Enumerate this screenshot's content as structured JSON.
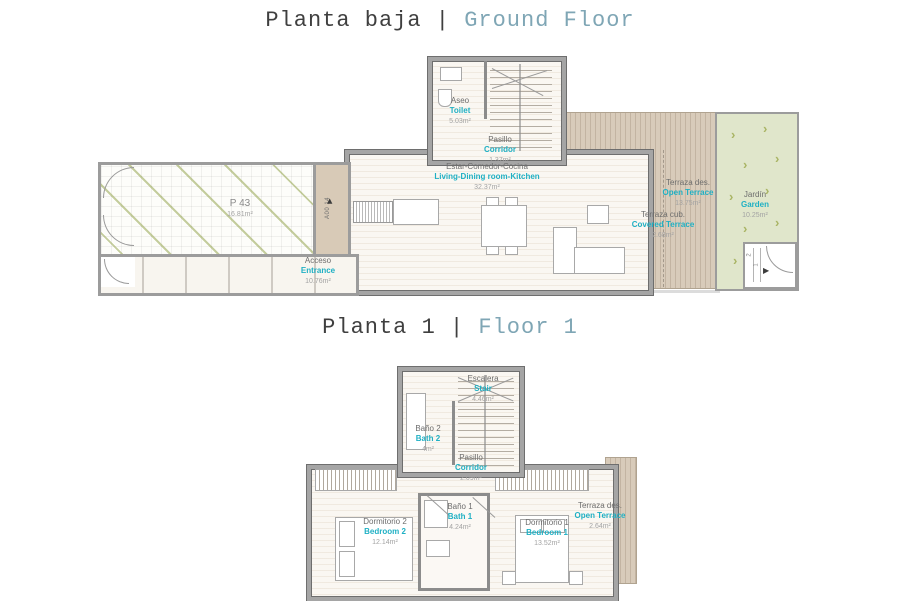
{
  "colors": {
    "accent_teal": "#1fb0c4",
    "title_teal": "#7fa6b5",
    "title_dark": "#3f3f3f",
    "label_gray": "#6d6d6d",
    "area_gray": "#a3a3a3",
    "garden_green": "#e0e6cb",
    "deck_tan": "#d8cbba"
  },
  "icons": {
    "door_arrow": "▶",
    "garden_chevron": "›"
  },
  "ground_floor": {
    "title": {
      "es": "Planta baja",
      "divider": "|",
      "en": "Ground Floor"
    },
    "door_tag": "A00 14",
    "garden_steps": {
      "step1": "1",
      "step2": "2"
    },
    "rooms": {
      "parking": {
        "es": "P 43",
        "area": "16.81m²"
      },
      "entrance": {
        "es": "Acceso",
        "en": "Entrance",
        "area": "10.76m²"
      },
      "toilet": {
        "es": "Aseo",
        "en": "Toilet",
        "area": "5.03m²"
      },
      "corridor": {
        "es": "Pasillo",
        "en": "Corridor",
        "area": "1.37m²"
      },
      "living": {
        "es": "Estar-Comedor-Cocina",
        "en": "Living-Dining room-Kitchen",
        "area": "32.37m²"
      },
      "open_terrace": {
        "es": "Terraza des.",
        "en": "Open Terrace",
        "area": "13.75m²"
      },
      "covered_terrace": {
        "es": "Terraza cub.",
        "en": "Covered Terrace",
        "area": "2.68m²"
      },
      "garden": {
        "es": "Jardín",
        "en": "Garden",
        "area": "10.25m²"
      }
    }
  },
  "floor_1": {
    "title": {
      "es": "Planta 1",
      "divider": "|",
      "en": "Floor 1"
    },
    "rooms": {
      "stair": {
        "es": "Escalera",
        "en": "Stair",
        "area": "4.46m²"
      },
      "bath_2": {
        "es": "Baño 2",
        "en": "Bath 2",
        "area": "4m²"
      },
      "corridor": {
        "es": "Pasillo",
        "en": "Corridor",
        "area": "2.09m²"
      },
      "bedroom_2": {
        "es": "Dormitorio 2",
        "en": "Bedroom 2",
        "area": "12.14m²"
      },
      "bath_1": {
        "es": "Baño 1",
        "en": "Bath 1",
        "area": "4.24m²"
      },
      "bedroom_1": {
        "es": "Dormitorio 1",
        "en": "Bedroom 1",
        "area": "13.52m²"
      },
      "open_terrace": {
        "es": "Terraza des.",
        "en": "Open Terrace",
        "area": "2.64m²"
      }
    }
  }
}
